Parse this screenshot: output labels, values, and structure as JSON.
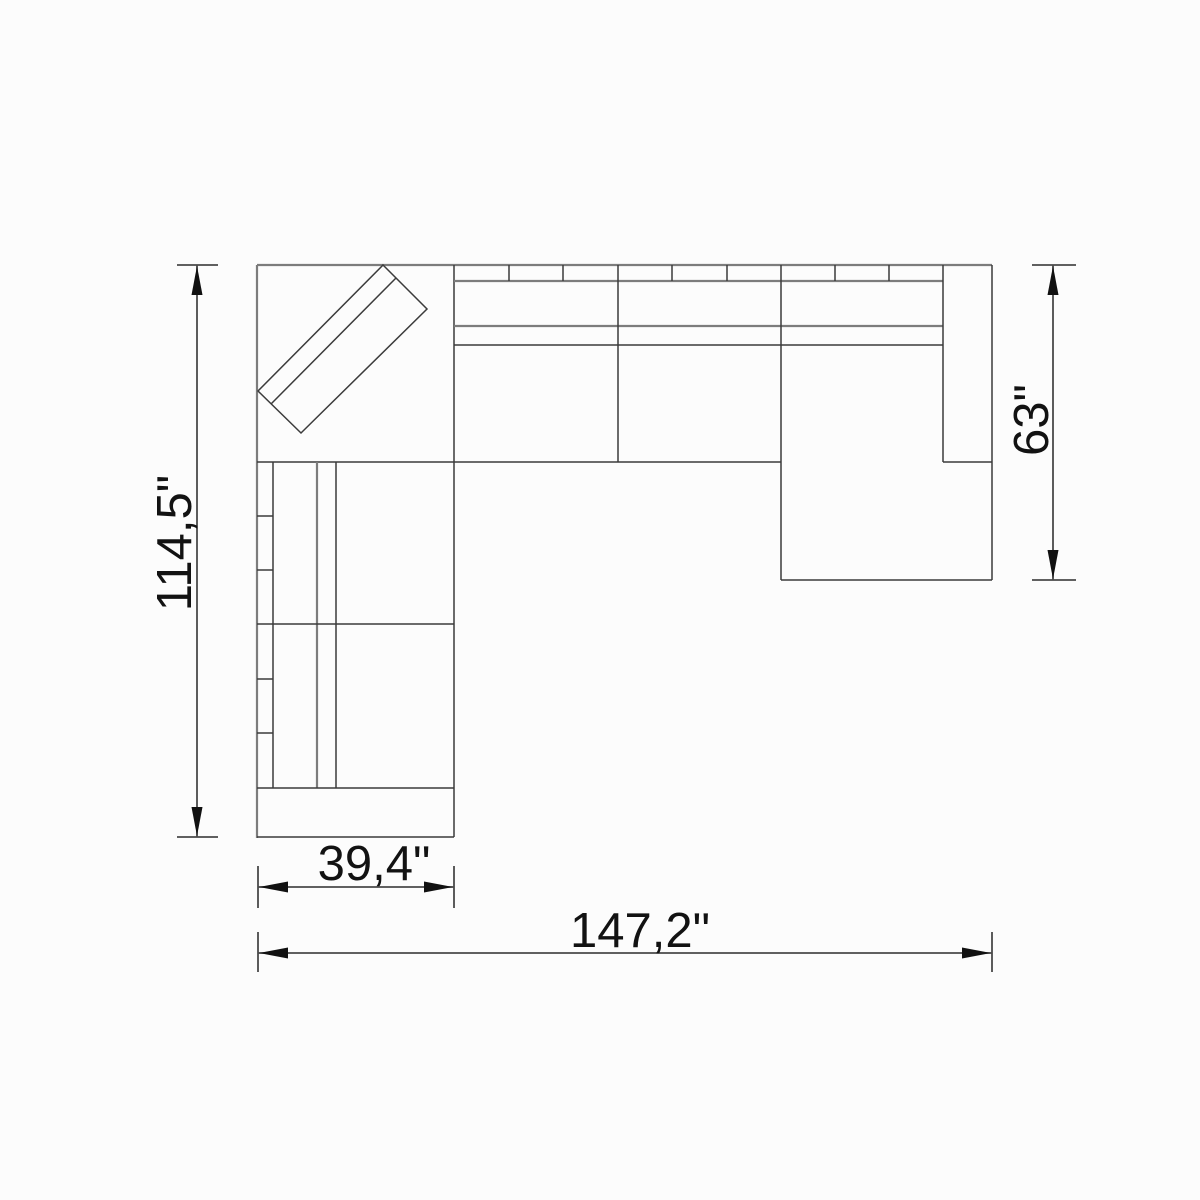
{
  "title": "Sectional sofa with chaise — top view dimension drawing",
  "drawing": {
    "view": "top-plan",
    "object": "sectional-sofa-with-corner-and-chaise",
    "units": "inches",
    "dimensions": {
      "overall_height": {
        "label": "114,5\"",
        "orientation": "vertical",
        "side": "left"
      },
      "chaise_depth": {
        "label": "63\"",
        "orientation": "vertical",
        "side": "right"
      },
      "left_section_width": {
        "label": "39,4\"",
        "orientation": "horizontal",
        "side": "bottom-left"
      },
      "overall_width": {
        "label": "147,2\"",
        "orientation": "horizontal",
        "side": "bottom"
      }
    },
    "colors": {
      "background": "#fcfcfc",
      "outline_gray": "#7c7c7c",
      "structure_dark": "#3b3b3b",
      "dimension_line": "#4a4a4a",
      "dimension_text": "#121212"
    }
  }
}
